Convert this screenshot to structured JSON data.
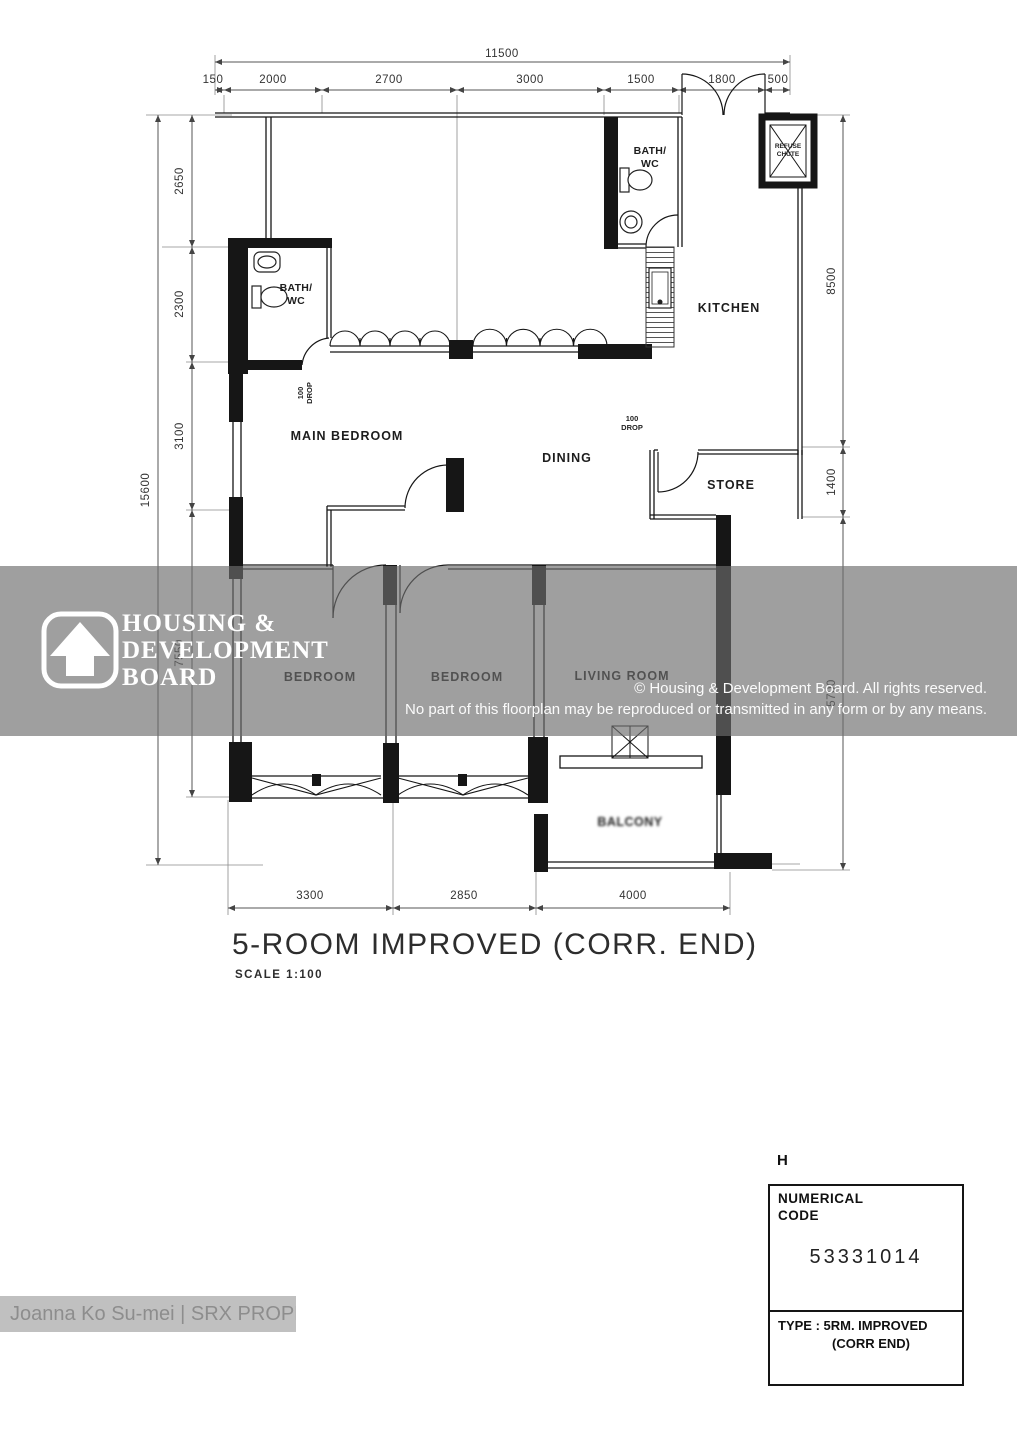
{
  "plan": {
    "title": "5-ROOM IMPROVED (CORR. END)",
    "scale": "SCALE 1:100"
  },
  "rooms": {
    "bath_top_1": "BATH/",
    "bath_top_2": "WC",
    "bath_left_1": "BATH/",
    "bath_left_2": "WC",
    "kitchen": "KITCHEN",
    "main_bedroom": "MAIN BEDROOM",
    "dining": "DINING",
    "store": "STORE",
    "bedroom_1": "BEDROOM",
    "bedroom_2": "BEDROOM",
    "living_room": "LIVING ROOM",
    "balcony": "BALCONY"
  },
  "annotations": {
    "refuse_1": "REFUSE",
    "refuse_2": "CHUTE",
    "drop_kitchen_1": "100",
    "drop_kitchen_2": "DROP",
    "drop_bath_1": "100",
    "drop_bath_2": "DROP"
  },
  "dims": {
    "top_total": "11500",
    "top": [
      "150",
      "2000",
      "2700",
      "3000",
      "1500",
      "1800",
      "500"
    ],
    "left_total": "15600",
    "left": [
      "2650",
      "2300",
      "3100",
      "7550"
    ],
    "right": [
      "8500",
      "1400",
      "5700"
    ],
    "bottom": [
      "3300",
      "2850",
      "4000"
    ]
  },
  "watermark": {
    "logo_1": "HOUSING &",
    "logo_2": "DEVELOPMENT",
    "logo_3": "BOARD",
    "copyright_1": "© Housing & Development Board. All rights reserved.",
    "copyright_2": "No part of this floorplan may be reproduced or transmitted in any form or by any means."
  },
  "info_box": {
    "corner": "H",
    "header_1": "NUMERICAL",
    "header_2": "CODE",
    "code": "53331014",
    "type_1": "TYPE : 5RM. IMPROVED",
    "type_2": "(CORR END)"
  },
  "agent": "Joanna Ko Su-mei | SRX PROPERTY"
}
